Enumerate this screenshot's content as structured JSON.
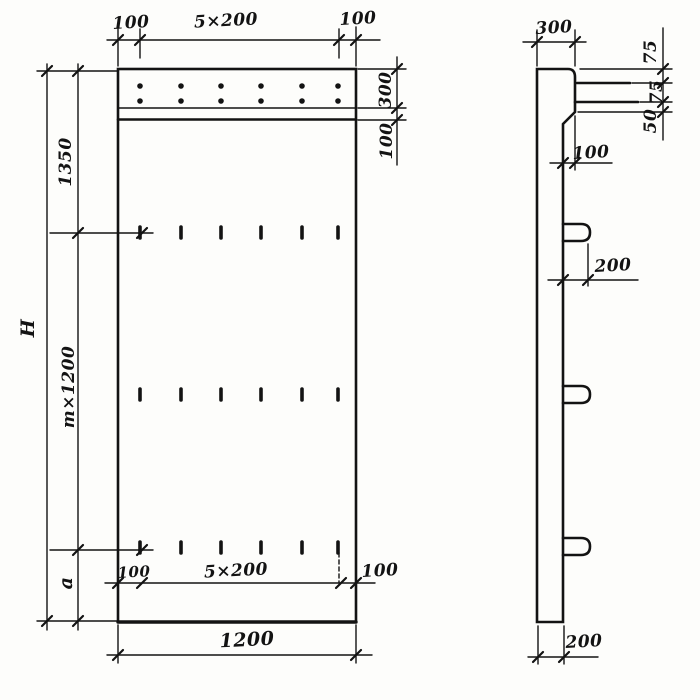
{
  "front_view": {
    "top_dim": {
      "left": "100",
      "center": "5×200",
      "right": "100"
    },
    "left_dim": {
      "overall": "H",
      "upper": "1350",
      "middle": "m×1200",
      "lower": "a"
    },
    "right_dim": {
      "ledge": "300",
      "lip": "100"
    },
    "lower_dim": {
      "left": "100",
      "center": "5×200",
      "right": "100"
    },
    "bottom_dim": {
      "width": "1200"
    }
  },
  "side_view": {
    "top_dim": {
      "width": "300"
    },
    "right_dim": {
      "upper": "75",
      "middle": "75",
      "lower": "50"
    },
    "offset_dim": {
      "value": "100"
    },
    "lug_dim": {
      "value": "200"
    },
    "bottom_dim": {
      "value": "200"
    }
  },
  "colors": {
    "ink": "#131313",
    "paper": "#fdfdfb"
  }
}
